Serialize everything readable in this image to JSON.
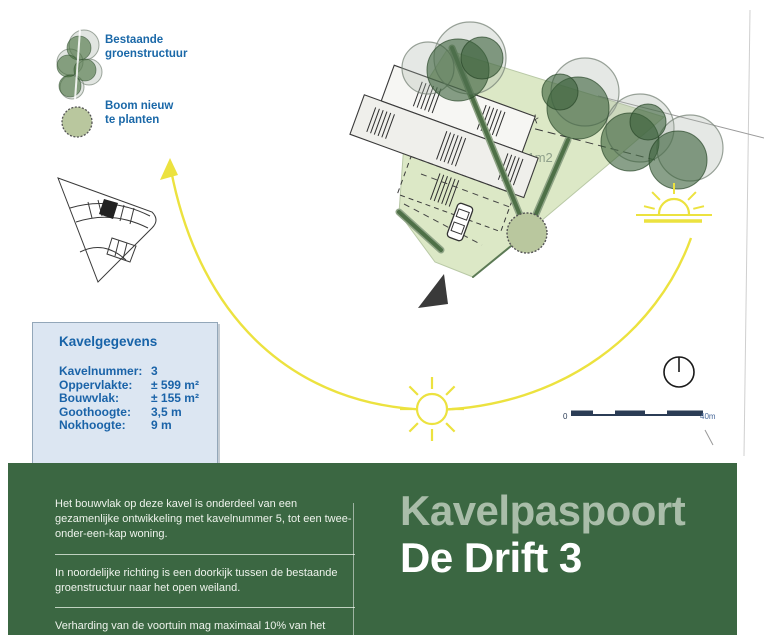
{
  "legend": {
    "existing_green_label": "Bestaande\ngroenstructuur",
    "new_tree_label": "Boom nieuw\nte planten"
  },
  "site_plan": {
    "green_strip_label": "Lijn groenstrook",
    "area_label": "591m2"
  },
  "kavelgegevens": {
    "title": "Kavelgegevens",
    "rows": [
      {
        "label": "Kavelnummer:",
        "value": "3"
      },
      {
        "label": "Oppervlakte:",
        "value": "± 599 m²"
      },
      {
        "label": "Bouwvlak:",
        "value": "± 155 m²"
      },
      {
        "label": "Goothoogte:",
        "value": "3,5 m"
      },
      {
        "label": "Nokhoogte:",
        "value": "9 m"
      }
    ]
  },
  "scale_bar": {
    "start_label": "0",
    "end_label": "40m"
  },
  "banner": {
    "title_line1": "Kavelpaspoort",
    "title_line2": "De Drift 3",
    "paragraphs": [
      "Het bouwvlak op deze kavel is onderdeel van een gezamenlijke ontwikkeling met kavelnummer 5, tot een twee-onder-een-kap woning.",
      "In noordelijke richting is een doorkijk tussen de bestaande groenstructuur naar het open weiland.",
      "Verharding van de voortuin mag maximaal 10% van het"
    ]
  },
  "colors": {
    "banner_green": "#3b6742",
    "title_muted": "#a9bda9",
    "info_blue": "#1a68a8",
    "box_background": "#dce6f2",
    "sun_yellow": "#ece23f",
    "plot_green": "#dce8c6",
    "scalebar_navy": "#2b3c55"
  }
}
